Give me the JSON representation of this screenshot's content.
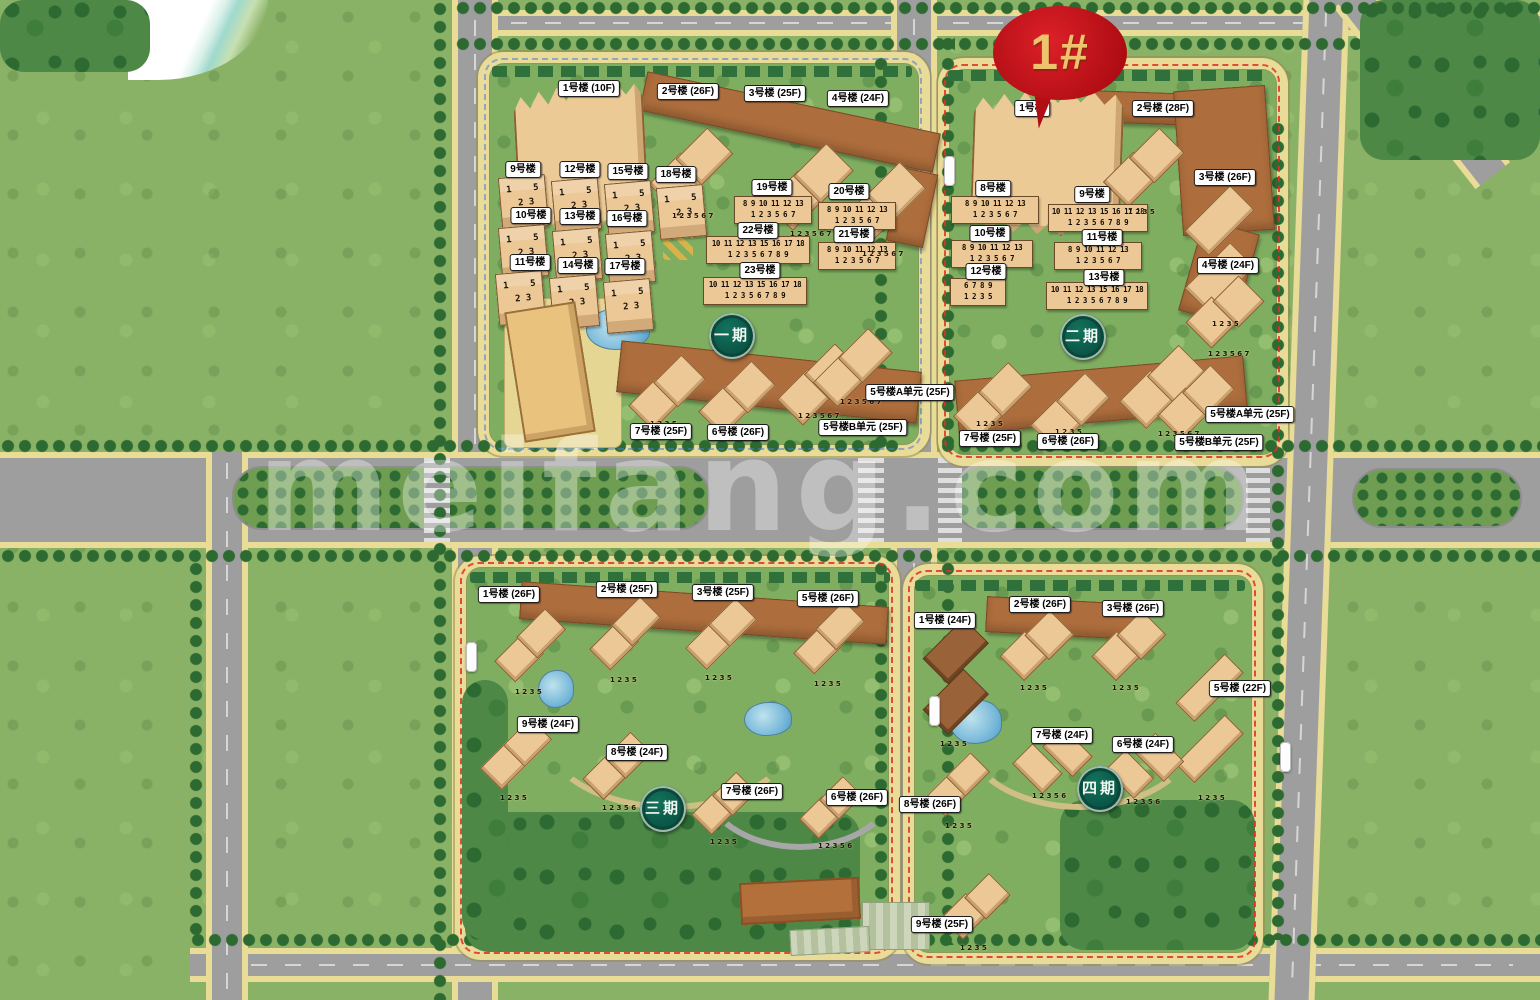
{
  "watermark": "meifang.com",
  "marker": {
    "label": "1#"
  },
  "badges": {
    "p1": "一期",
    "p2": "二期",
    "p3": "三期",
    "p4": "四期"
  },
  "units": {
    "small": "1    5\n 2 3",
    "row6": "8 9 10 11 12 13\n1 2 3 5 6 7",
    "row8": "10 11 12 13 15 16 17 18\n1 2 3 5 6 7 8 9",
    "row4": "6 7 8 9\n1 2 3 5",
    "t4": "1 2 3 5",
    "t5": "1 2 3 5 6",
    "t6": "1 2 3 5 6 7"
  },
  "phase1": {
    "b1": "1号楼 (10F)",
    "b2": "2号楼 (26F)",
    "b3": "3号楼 (25F)",
    "b4": "4号楼 (24F)",
    "b5a": "5号楼A单元 (25F)",
    "b5b": "5号楼B单元 (25F)",
    "b6": "6号楼 (26F)",
    "b7": "7号楼 (25F)",
    "b9": "9号楼",
    "b10": "10号楼",
    "b11": "11号楼",
    "b12": "12号楼",
    "b13": "13号楼",
    "b14": "14号楼",
    "b15": "15号楼",
    "b16": "16号楼",
    "b17": "17号楼",
    "b18": "18号楼",
    "b19": "19号楼",
    "b20": "20号楼",
    "b21": "21号楼",
    "b22": "22号楼",
    "b23": "23号楼"
  },
  "phase2": {
    "b1": "1号楼",
    "b2": "2号楼 (28F)",
    "b3": "3号楼 (26F)",
    "b4": "4号楼 (24F)",
    "b5a": "5号楼A单元 (25F)",
    "b5b": "5号楼B单元 (25F)",
    "b6": "6号楼 (26F)",
    "b7": "7号楼 (25F)",
    "b8": "8号楼",
    "b9": "9号楼",
    "b10": "10号楼",
    "b11": "11号楼",
    "b12": "12号楼",
    "b13": "13号楼"
  },
  "phase3": {
    "b1": "1号楼 (26F)",
    "b2": "2号楼 (25F)",
    "b3": "3号楼 (25F)",
    "b5": "5号楼 (26F)",
    "b6": "6号楼 (26F)",
    "b7": "7号楼 (26F)",
    "b8": "8号楼 (24F)",
    "b9": "9号楼 (24F)"
  },
  "phase4": {
    "b1": "1号楼 (24F)",
    "b2": "2号楼 (26F)",
    "b3": "3号楼 (26F)",
    "b5": "5号楼 (22F)",
    "b6": "6号楼 (24F)",
    "b7": "7号楼 (24F)",
    "b8": "8号楼 (26F)",
    "b9": "9号楼 (25F)"
  },
  "colors": {
    "grass": "#8ab266",
    "road": "#9e9e9e",
    "sand_edge": "#e9dc96",
    "building_tan": "#ecc897",
    "roof_brown": "#ad6d3c",
    "marker_red": "#b50f16",
    "marker_text_gold": "#efc26e",
    "badge_green": "#0a4f41",
    "boundary_red": "#e03128",
    "water_blue": "#6fb3d6"
  }
}
